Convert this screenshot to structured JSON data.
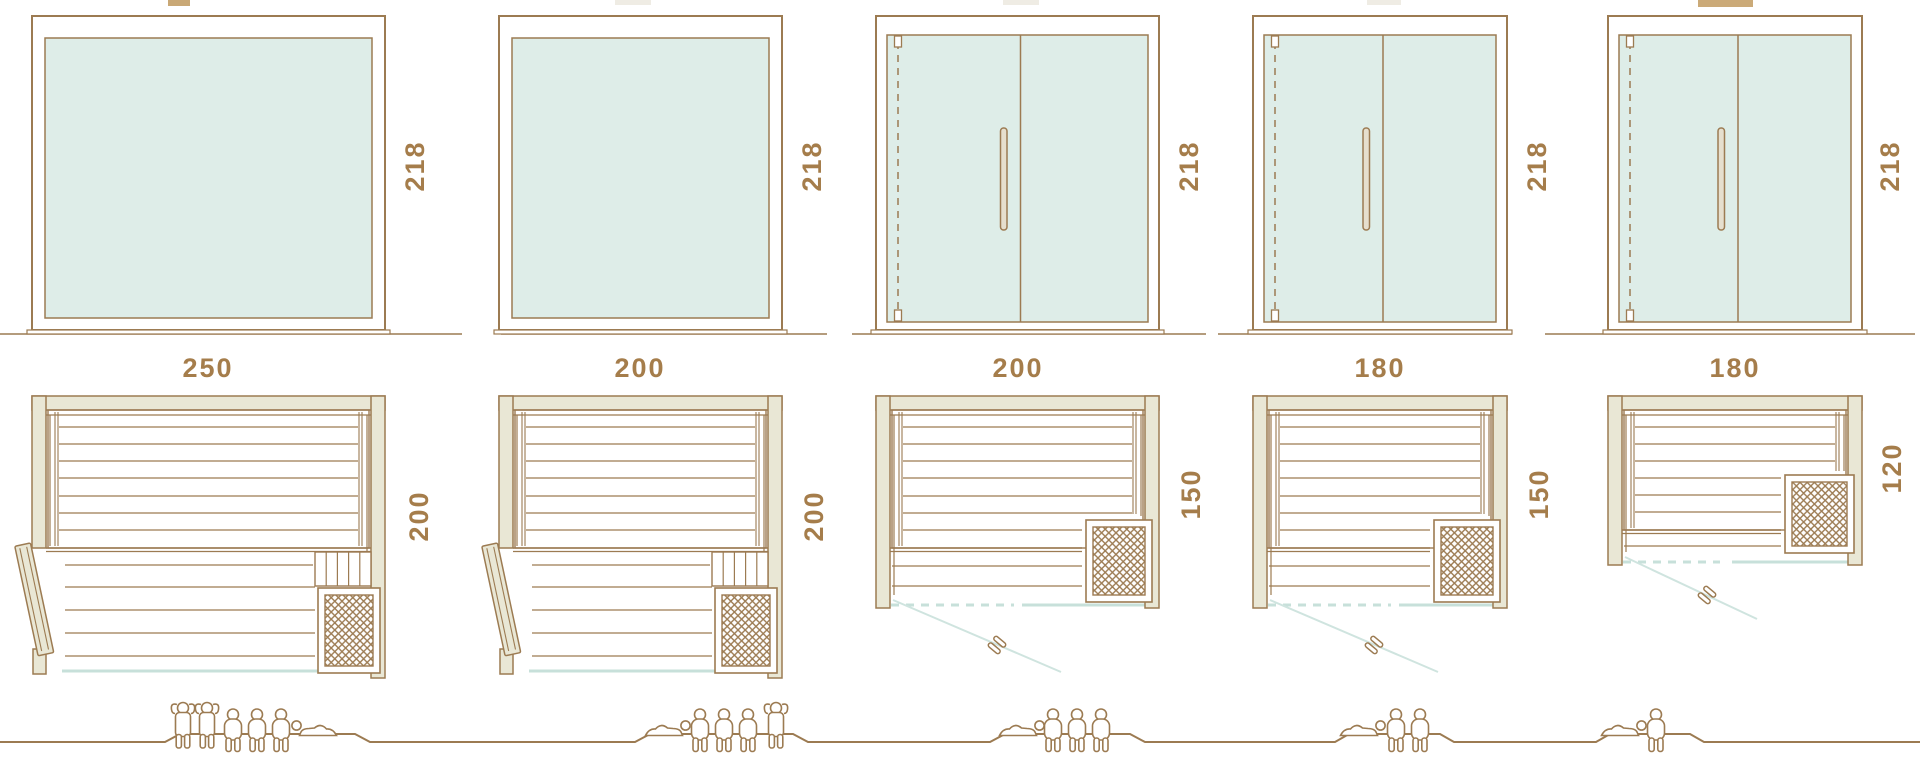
{
  "palette": {
    "line": "#9C7B52",
    "label_text": "#A57D4B",
    "wall_fill": "#E9E7D5",
    "glass_fill": "#DEEDE8",
    "glass_edge_blue": "#C7E0DA",
    "door_swing_blue": "#CFE4DF",
    "handle_fill": "#E6DFCE",
    "background": "#FFFFFF"
  },
  "units": [
    {
      "front": {
        "width": "250",
        "height": "218",
        "glass_doors": false
      },
      "plan": {
        "depth": "200",
        "door": "wood-side-door",
        "heater": "bottom-right"
      },
      "capacity": {
        "standing": 2,
        "sitting": 3,
        "lying": 1
      },
      "people_order": [
        "standing",
        "standing",
        "sitting",
        "sitting",
        "sitting",
        "lying"
      ]
    },
    {
      "front": {
        "width": "200",
        "height": "218",
        "glass_doors": false
      },
      "plan": {
        "depth": "200",
        "door": "wood-side-door",
        "heater": "bottom-right"
      },
      "capacity": {
        "standing": 1,
        "sitting": 3,
        "lying": 1
      },
      "people_order": [
        "lying",
        "sitting",
        "sitting",
        "sitting",
        "standing"
      ]
    },
    {
      "front": {
        "width": "200",
        "height": "218",
        "glass_doors": true
      },
      "plan": {
        "depth": "150",
        "door": "glass-front-door",
        "heater": "bottom-right"
      },
      "capacity": {
        "standing": 0,
        "sitting": 3,
        "lying": 1
      },
      "people_order": [
        "lying",
        "sitting",
        "sitting",
        "sitting"
      ]
    },
    {
      "front": {
        "width": "180",
        "height": "218",
        "glass_doors": true
      },
      "plan": {
        "depth": "150",
        "door": "glass-front-door",
        "heater": "bottom-right"
      },
      "capacity": {
        "standing": 0,
        "sitting": 2,
        "lying": 1
      },
      "people_order": [
        "lying",
        "sitting",
        "sitting"
      ]
    },
    {
      "front": {
        "width": "180",
        "height": "218",
        "glass_doors": true
      },
      "plan": {
        "depth": "120",
        "door": "glass-front-door",
        "heater": "right"
      },
      "capacity": {
        "standing": 0,
        "sitting": 1,
        "lying": 1
      },
      "people_order": [
        "lying",
        "sitting"
      ]
    }
  ]
}
